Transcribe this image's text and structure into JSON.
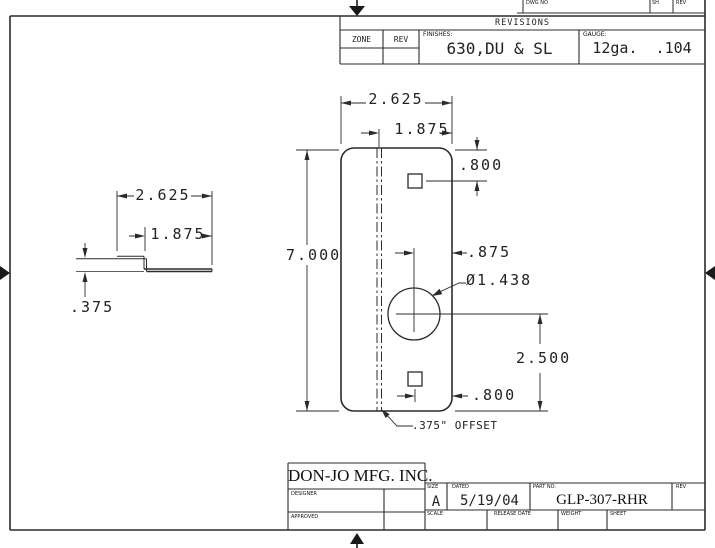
{
  "top_strip": {
    "dwg_no_label": "DWG NO",
    "sh_label": "SH",
    "rev_label": "REV"
  },
  "revisions": {
    "title": "REVISIONS",
    "zone_label": "ZONE",
    "rev_label": "REV",
    "finishes_label": "FINISHES:",
    "finishes_value": "630,DU & SL",
    "gauge_label": "GAUGE:",
    "gauge_value": "12ga.  .104"
  },
  "front_view": {
    "width": "2.625",
    "flat_width": "1.875",
    "height": "7.000",
    "top_hole_offset": ".800",
    "center_to_edge": ".875",
    "hole_diameter": "Ø1.438",
    "center_to_bottom": "2.500",
    "bottom_hole_offset": ".800",
    "offset_note": ".375\" OFFSET"
  },
  "side_view": {
    "width": "2.625",
    "flat_width": "1.875",
    "offset_depth": ".375"
  },
  "title_block": {
    "company": "DON-JO MFG. INC.",
    "designer_label": "DESIGNER",
    "approved_label": "APPROVED",
    "size_label": "SIZE",
    "size_value": "A",
    "date_label": "DATED",
    "date_value": "5/19/04",
    "part_label": "PART NO.",
    "part_value": "GLP-307-RHR",
    "rev_label": "REV",
    "scale_label": "SCALE",
    "release_label": "RELEASE DATE",
    "weight_label": "WEIGHT",
    "sheet_label": "SHEET"
  },
  "colors": {
    "line": "#2b2b2b",
    "background": "#ffffff"
  }
}
